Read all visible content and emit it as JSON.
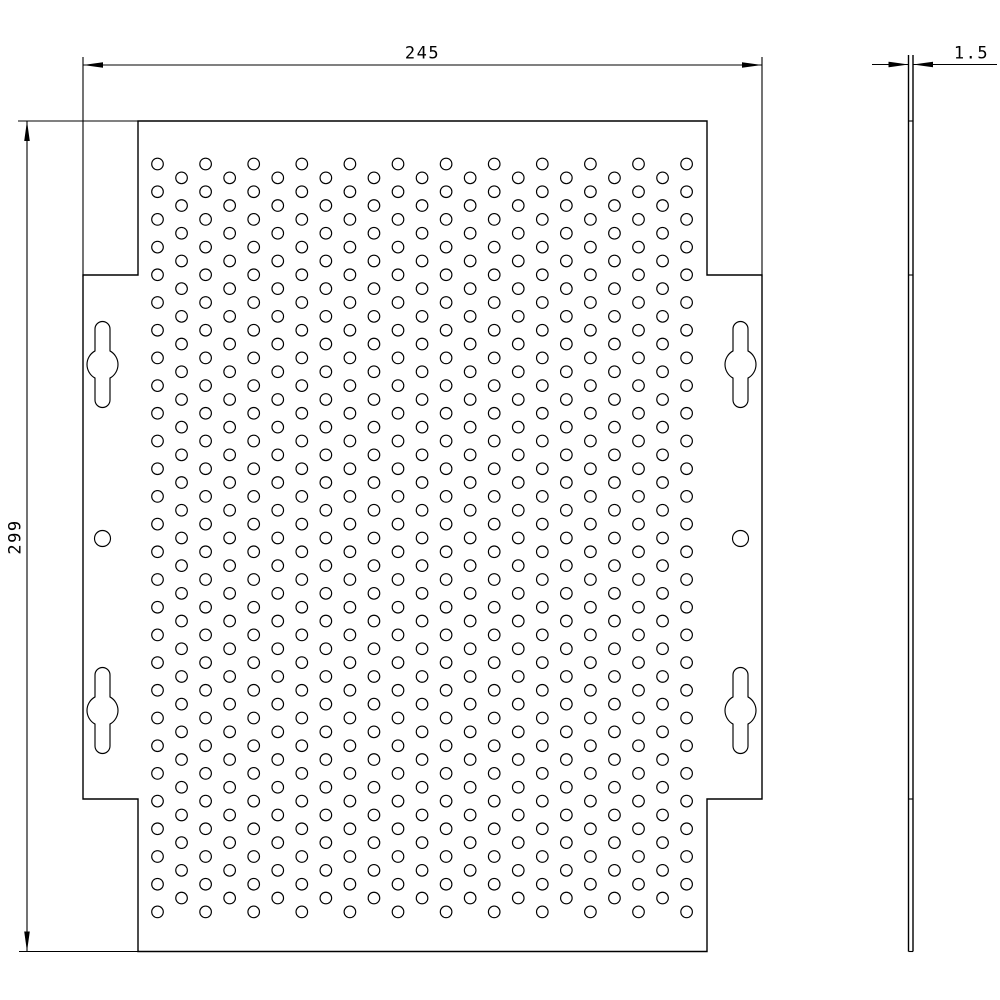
{
  "dimensions": {
    "width": {
      "label": "245"
    },
    "height": {
      "label": "299"
    },
    "thickness": {
      "label": "1.5"
    }
  },
  "geometry": {
    "front": {
      "outline": {
        "left": 83,
        "right": 762,
        "top": 121,
        "bottom": 951.5,
        "inner_left": 138,
        "inner_right": 707,
        "notch_top": 275,
        "notch_bottom": 799
      },
      "holes": {
        "x0": 157.5,
        "col_pitch": 24.05,
        "cols": 23,
        "y0_even": 164,
        "rows_even": 28,
        "y0_odd": 177.85,
        "rows_odd": 27,
        "row_pitch": 27.7,
        "radius": 5.8
      },
      "keyholes": {
        "centers": [
          [
            102.5,
            364.5
          ],
          [
            740.5,
            364.5
          ],
          [
            102.5,
            710.5
          ],
          [
            740.5,
            710.5
          ]
        ],
        "slot_half_width": 7.5,
        "cap_center_offset": 35.5,
        "bulge_radius": 15.5
      },
      "pilot_holes": {
        "centers": [
          [
            102.5,
            538.5
          ],
          [
            740.5,
            538.5
          ]
        ],
        "radius": 8
      }
    },
    "side": {
      "x_left": 908.5,
      "x_right": 913,
      "y_top": 55,
      "y_bottom": 951.5,
      "ticks": [
        121,
        275,
        799,
        951.5
      ]
    },
    "dims": {
      "width_dim": {
        "y": 65,
        "x1": 83,
        "x2": 762,
        "ext_y1": 57,
        "ext_y2": 277,
        "label_x": 422.5,
        "label_y": 54
      },
      "height_dim": {
        "x": 27,
        "y1": 121,
        "y2": 951.5,
        "ext_x1_top": 18,
        "ext_x1_bottom": 19,
        "ext_x2": 140,
        "label_x": 15.5,
        "label_y": 536.5
      },
      "thick_dim": {
        "y": 64.5,
        "tail_left_x": 872,
        "tail_right_x": 997,
        "label_x": 971.5,
        "label_y": 53.5
      }
    },
    "style": {
      "line_color": "#000000",
      "background": "#ffffff",
      "outline_width": 1.4,
      "hole_width": 1.15,
      "dim_width": 1.1,
      "arrow_len": 20,
      "arrow_half_w": 2.8
    }
  }
}
